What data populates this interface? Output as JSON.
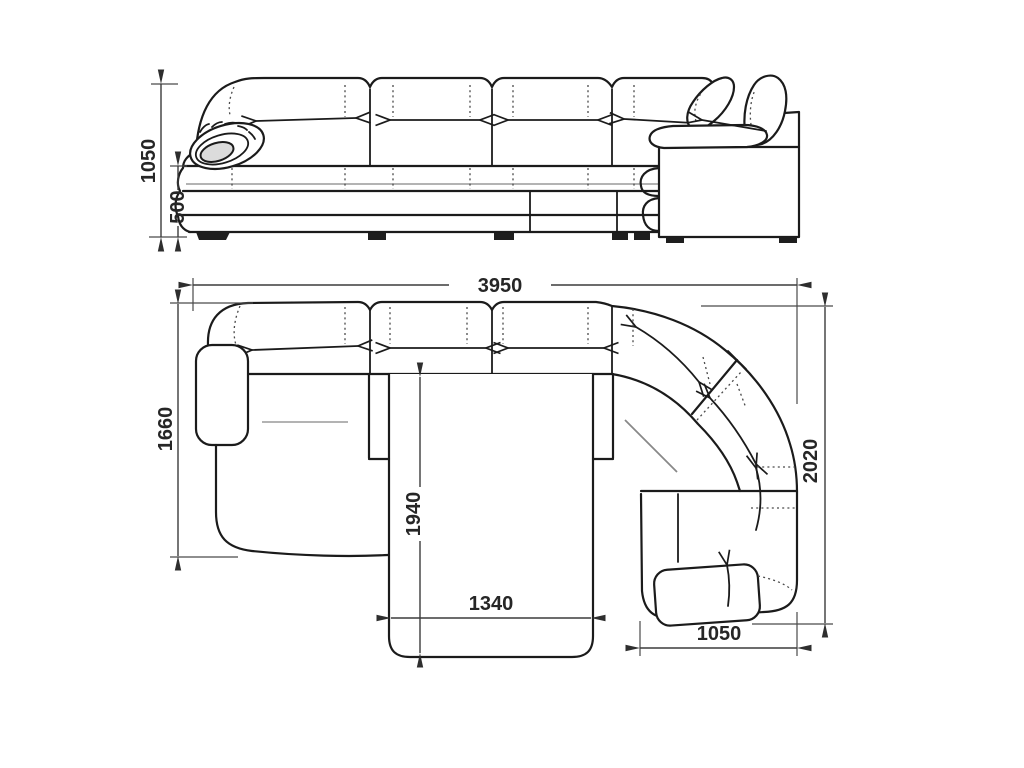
{
  "drawing": {
    "views": {
      "front_elevation": {
        "dim_total_height": "1050",
        "dim_seat_height": "500"
      },
      "top_plan": {
        "dim_total_width": "3950",
        "dim_left_depth": "1660",
        "dim_bed_extension": "1940",
        "dim_bed_width": "1340",
        "dim_corner_section_width": "1050",
        "dim_right_depth": "2020"
      }
    },
    "colors": {
      "background": "#ffffff",
      "line": "#1b1b1b",
      "dimension_line": "#3c3c3c",
      "dimension_text": "#262626",
      "accent_gray": "#9a9a9a",
      "scroll_shade": "#dcdcdc"
    }
  }
}
